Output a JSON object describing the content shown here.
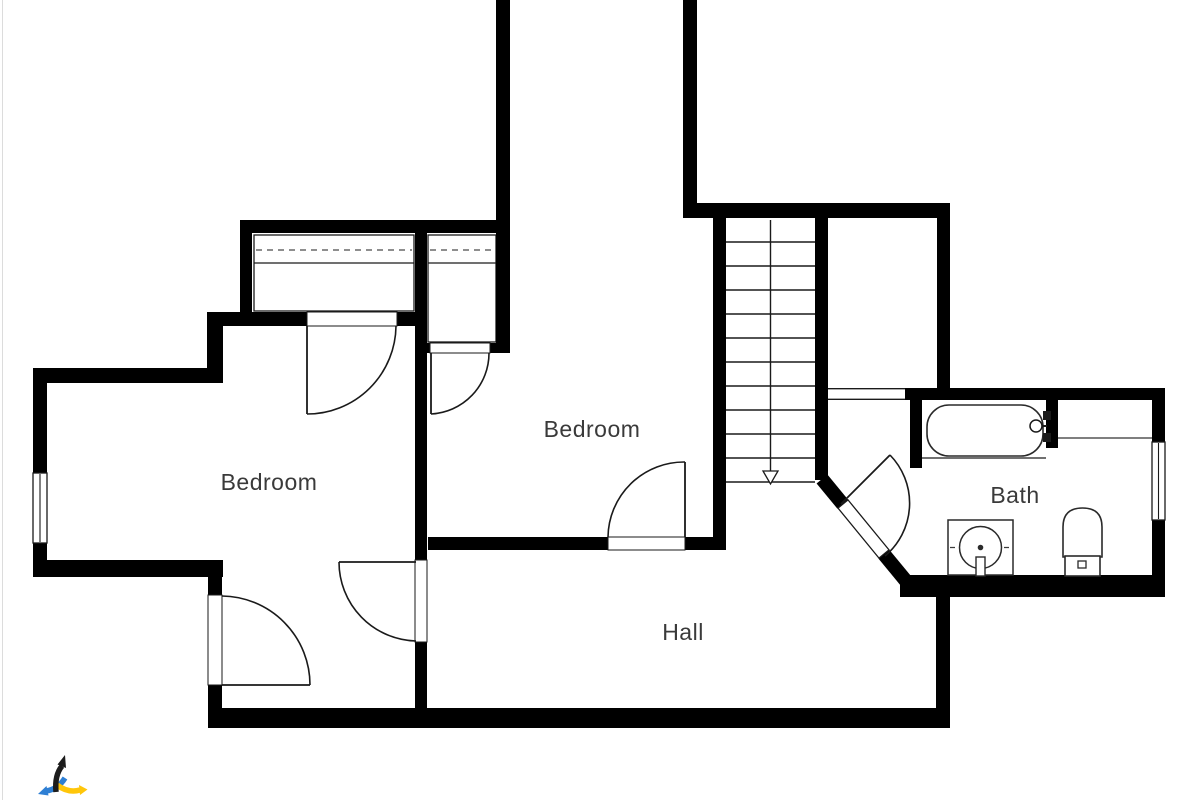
{
  "style": {
    "bg": "#ffffff",
    "wall_color": "#000000",
    "line_color": "#1a1a1a",
    "dash_color": "#4a4a4a",
    "text_color": "#3a3a3a",
    "label_font_px": 23,
    "edge_line_color": "#dcdcdc"
  },
  "rooms": [
    {
      "id": "bedroom-left",
      "label": "Bedroom",
      "cx": 269,
      "baseline": 490
    },
    {
      "id": "bedroom-middle",
      "label": "Bedroom",
      "cx": 592,
      "baseline": 437
    },
    {
      "id": "hall",
      "label": "Hall",
      "cx": 683,
      "baseline": 640
    },
    {
      "id": "bath",
      "label": "Bath",
      "cx": 1015,
      "baseline": 503
    }
  ],
  "plan": {
    "walls": [
      [
        496,
        0,
        14,
        233
      ],
      [
        683,
        0,
        14,
        218
      ],
      [
        683,
        203,
        267,
        15
      ],
      [
        240,
        220,
        270,
        13
      ],
      [
        240,
        233,
        12,
        87
      ],
      [
        207,
        312,
        100,
        14
      ],
      [
        397,
        312,
        30,
        14
      ],
      [
        207,
        312,
        16,
        71
      ],
      [
        35,
        368,
        188,
        15
      ],
      [
        33,
        368,
        14,
        209
      ],
      [
        33,
        560,
        190,
        17
      ],
      [
        208,
        577,
        14,
        133
      ],
      [
        415,
        233,
        12,
        477
      ],
      [
        496,
        233,
        14,
        120
      ],
      [
        427,
        343,
        4,
        10
      ],
      [
        488,
        343,
        8,
        10
      ],
      [
        713,
        218,
        13,
        332
      ],
      [
        428,
        537,
        297,
        13
      ],
      [
        815,
        218,
        13,
        262
      ],
      [
        905,
        388,
        260,
        12
      ],
      [
        937,
        218,
        13,
        182
      ],
      [
        910,
        400,
        12,
        68
      ],
      [
        1152,
        398,
        13,
        199
      ],
      [
        900,
        575,
        265,
        22
      ],
      [
        936,
        597,
        14,
        113
      ],
      [
        208,
        708,
        742,
        20
      ],
      [
        1046,
        398,
        12,
        50
      ]
    ],
    "diagonal": {
      "x1": 822,
      "y1": 479,
      "x2": 906,
      "y2": 581,
      "t": 14,
      "gap": [
        843,
        504,
        884,
        554
      ],
      "leaf_w": 13
    },
    "openings": [
      {
        "type": "window",
        "x": 33,
        "y": 473,
        "w": 14,
        "h": 70
      },
      {
        "type": "window",
        "x": 1152,
        "y": 442,
        "w": 13,
        "h": 78
      },
      {
        "type": "passage",
        "x": 828,
        "y": 388,
        "w": 77,
        "h": 12
      },
      {
        "type": "jamb",
        "x": 307,
        "y": 312,
        "w": 90,
        "h": 14
      },
      {
        "type": "jamb",
        "x": 430,
        "y": 343,
        "w": 60,
        "h": 10
      },
      {
        "type": "jamb",
        "x": 415,
        "y": 560,
        "w": 12,
        "h": 82
      },
      {
        "type": "jamb",
        "x": 608,
        "y": 537,
        "w": 77,
        "h": 13
      },
      {
        "type": "jamb",
        "x": 208,
        "y": 595,
        "w": 14,
        "h": 90
      }
    ],
    "doors": [
      {
        "id": "door-left-closet",
        "leaf": [
          307,
          326,
          307,
          414
        ],
        "arc": {
          "r": 89,
          "from": [
            307,
            414
          ],
          "to": [
            396,
            326
          ],
          "sweep": 0
        }
      },
      {
        "id": "door-middle-closet",
        "leaf": [
          431,
          353,
          431,
          414
        ],
        "arc": {
          "r": 61,
          "from": [
            431,
            414
          ],
          "to": [
            489,
            353
          ],
          "sweep": 0
        }
      },
      {
        "id": "door-bedrooms",
        "leaf": [
          416,
          562,
          339,
          562
        ],
        "arc": {
          "r": 79,
          "from": [
            339,
            562
          ],
          "to": [
            416,
            641
          ],
          "sweep": 0
        }
      },
      {
        "id": "door-middle-hall",
        "leaf": [
          685,
          537,
          685,
          462
        ],
        "arc": {
          "r": 76,
          "from": [
            608,
            537
          ],
          "to": [
            685,
            462
          ],
          "sweep": 1
        }
      },
      {
        "id": "door-left-hall",
        "leaf": [
          222,
          685,
          310,
          685
        ],
        "arc": {
          "r": 89,
          "from": [
            222,
            596
          ],
          "to": [
            310,
            685
          ],
          "sweep": 1
        }
      },
      {
        "id": "door-bath",
        "leaf": [
          841,
          504,
          890,
          455
        ],
        "arc": {
          "r": 69,
          "from": [
            890,
            455
          ],
          "to": [
            885,
            556
          ],
          "sweep": 1
        }
      }
    ],
    "stairs": {
      "x": 726,
      "y_top": 218,
      "w": 89,
      "y_bottom": 482,
      "tread_count": 11,
      "arrow": {
        "x": 770.5,
        "y1": 220,
        "y2": 471,
        "head_w": 15,
        "head_h": 13
      }
    },
    "closets": [
      {
        "rect": [
          254,
          235,
          160,
          76
        ],
        "dash_y": 250,
        "solid_y": 263
      },
      {
        "rect": [
          428,
          235,
          68,
          107
        ],
        "dash_y": 250,
        "solid_y": 263
      }
    ],
    "fixtures": {
      "tub": {
        "x": 927,
        "y": 405,
        "w": 116,
        "h": 51,
        "rx": 22
      },
      "tub_shelf_line": [
        922,
        458,
        1046,
        458
      ],
      "niche_line": [
        1058,
        438,
        1152,
        438
      ],
      "faucet": {
        "cx": 1036,
        "cy": 426,
        "r": 6,
        "mounts": [
          [
            1043,
            411,
            8,
            9
          ],
          [
            1043,
            433,
            8,
            9
          ]
        ]
      },
      "sink": {
        "x": 948,
        "y": 520,
        "w": 65,
        "h": 55,
        "r": 21,
        "dot_r": 2.8,
        "tap": [
          976,
          557,
          9,
          19
        ]
      },
      "toilet": {
        "bowl": [
          1063,
          508,
          39,
          49
        ],
        "bowl_rx": 19,
        "tank": [
          1065,
          556,
          35,
          20
        ],
        "button": [
          1078,
          561,
          8,
          7
        ]
      }
    }
  },
  "logo": {
    "x": 38,
    "y": 754,
    "black": "#1c1c1c",
    "blue": "#2e7fd4",
    "yellow": "#ffc60a"
  }
}
